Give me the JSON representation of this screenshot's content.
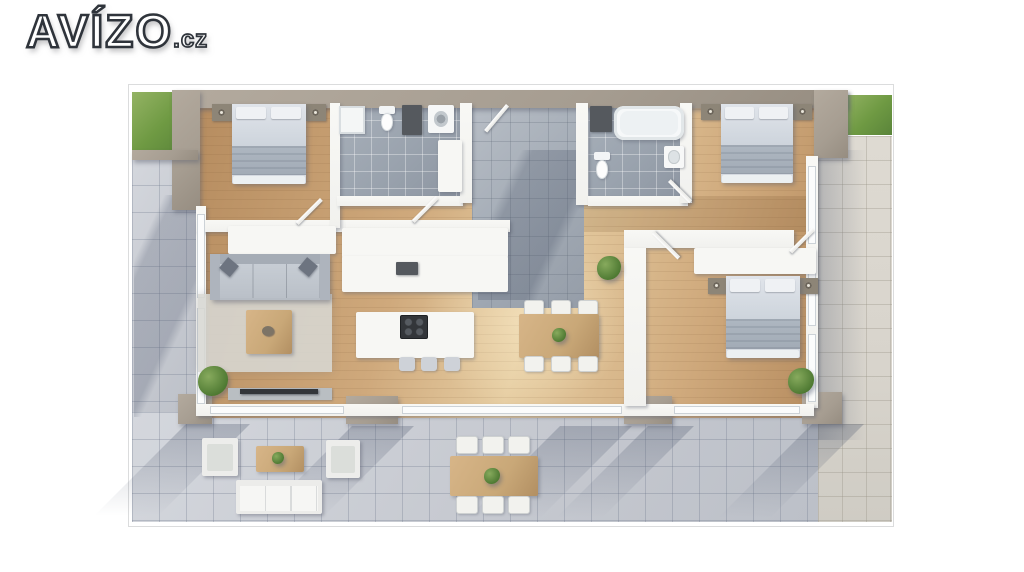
{
  "logo": {
    "text": "AVÍZO",
    "suffix": ".cz"
  },
  "palette": {
    "pageBg": "#ffffff",
    "frameBorder": "#dbdcdd",
    "wood": "#cfa97c",
    "woodDark": "#b68c5f",
    "woodLight": "#e6cda2",
    "woodTable": "#c9a878",
    "tileBath": "#99a2ad",
    "tileEntry": "#a4acb6",
    "tileTerrace": "#c7cad1",
    "tileBeige": "#d8d4cc",
    "grass": "#6f9a43",
    "grassLight": "#94b364",
    "wallWhite": "#f1f1ee",
    "wallTaupe": "#a69d91",
    "furnWhite": "#f7f7f4",
    "sofaGray": "#b6bcc4",
    "bedSheet": "#d5dae1",
    "bedBlanket": "#aeb7c1",
    "darkUnit": "#55595e",
    "tvBlack": "#33363a",
    "logoFill": "#ffffff",
    "logoOutline": "#2f343b"
  }
}
